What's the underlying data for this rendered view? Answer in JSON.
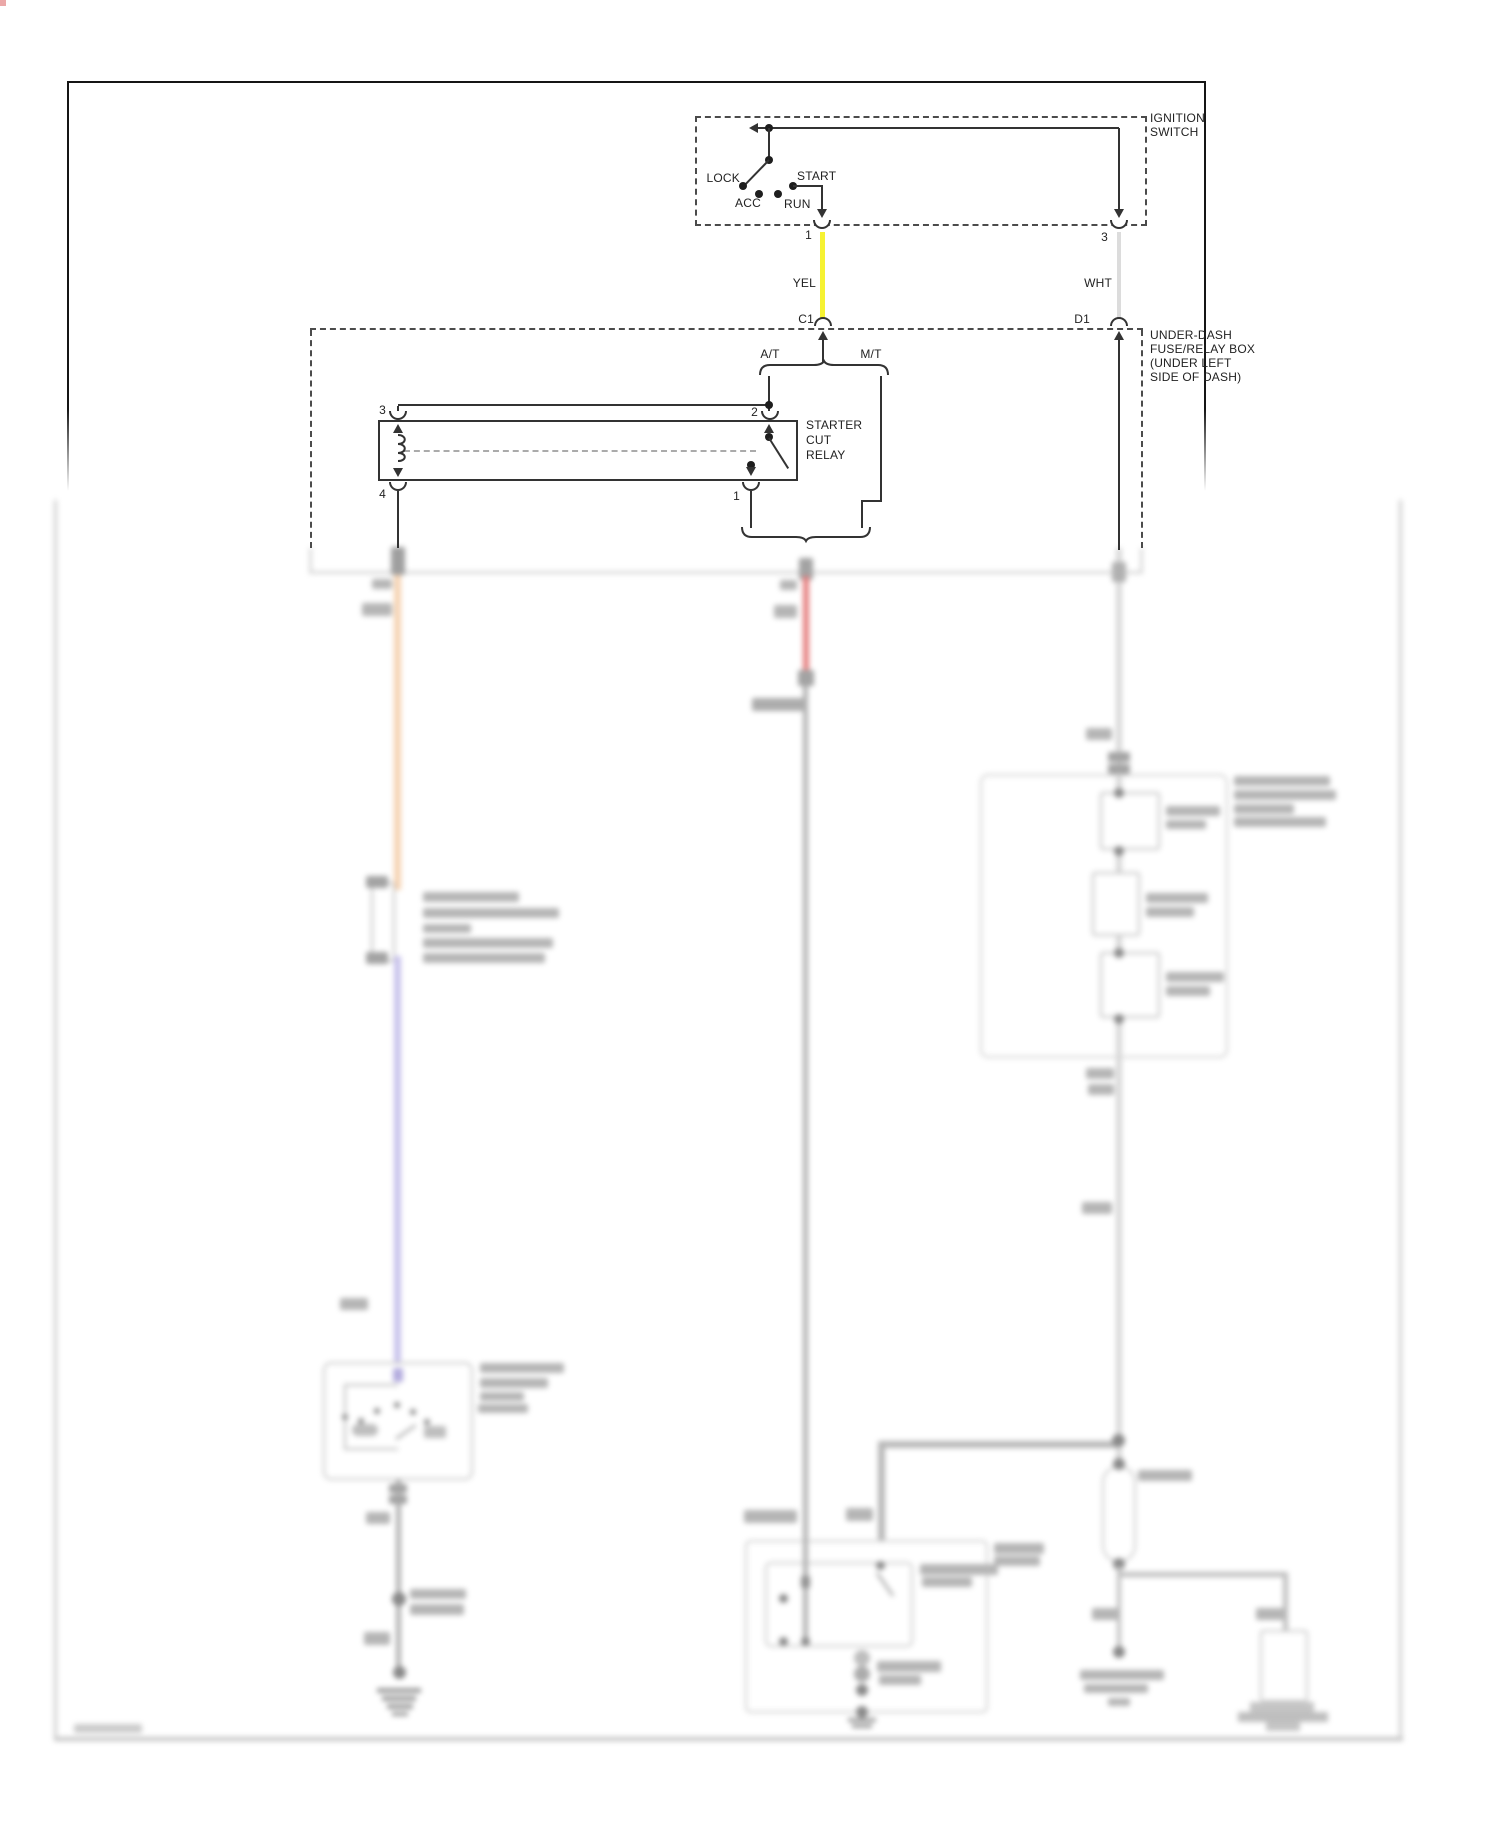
{
  "diagram": {
    "ignition_switch": {
      "label_lines": [
        "IGNITION",
        "SWITCH"
      ],
      "positions": {
        "lock": "LOCK",
        "acc": "ACC",
        "run": "RUN",
        "start": "START"
      },
      "pins": {
        "start": "1",
        "battery": "3"
      }
    },
    "wires": {
      "yellow": {
        "label": "YEL",
        "color": "#f6f232"
      },
      "white": {
        "label": "WHT",
        "color": "#dcdcdc"
      }
    },
    "connectors": {
      "c1": "C1",
      "d1": "D1"
    },
    "underdash_box": {
      "label_lines": [
        "UNDER-DASH",
        "FUSE/RELAY BOX",
        "(UNDER LEFT",
        "SIDE OF DASH)"
      ],
      "transmission_auto": "A/T",
      "transmission_manual": "M/T"
    },
    "starter_cut_relay": {
      "label_lines": [
        "STARTER",
        "CUT",
        "RELAY"
      ],
      "pins": {
        "top_left": "3",
        "top_right": "2",
        "bottom_left": "4",
        "bottom_right": "1"
      }
    },
    "blurred_section_colors": {
      "orange_wire": "#f3c9a2",
      "red_wire": "#e06262",
      "lavender_wire": "#bdb6e8",
      "gray_wire": "#a0a0a0",
      "white_wire": "#cfcfcf"
    }
  }
}
